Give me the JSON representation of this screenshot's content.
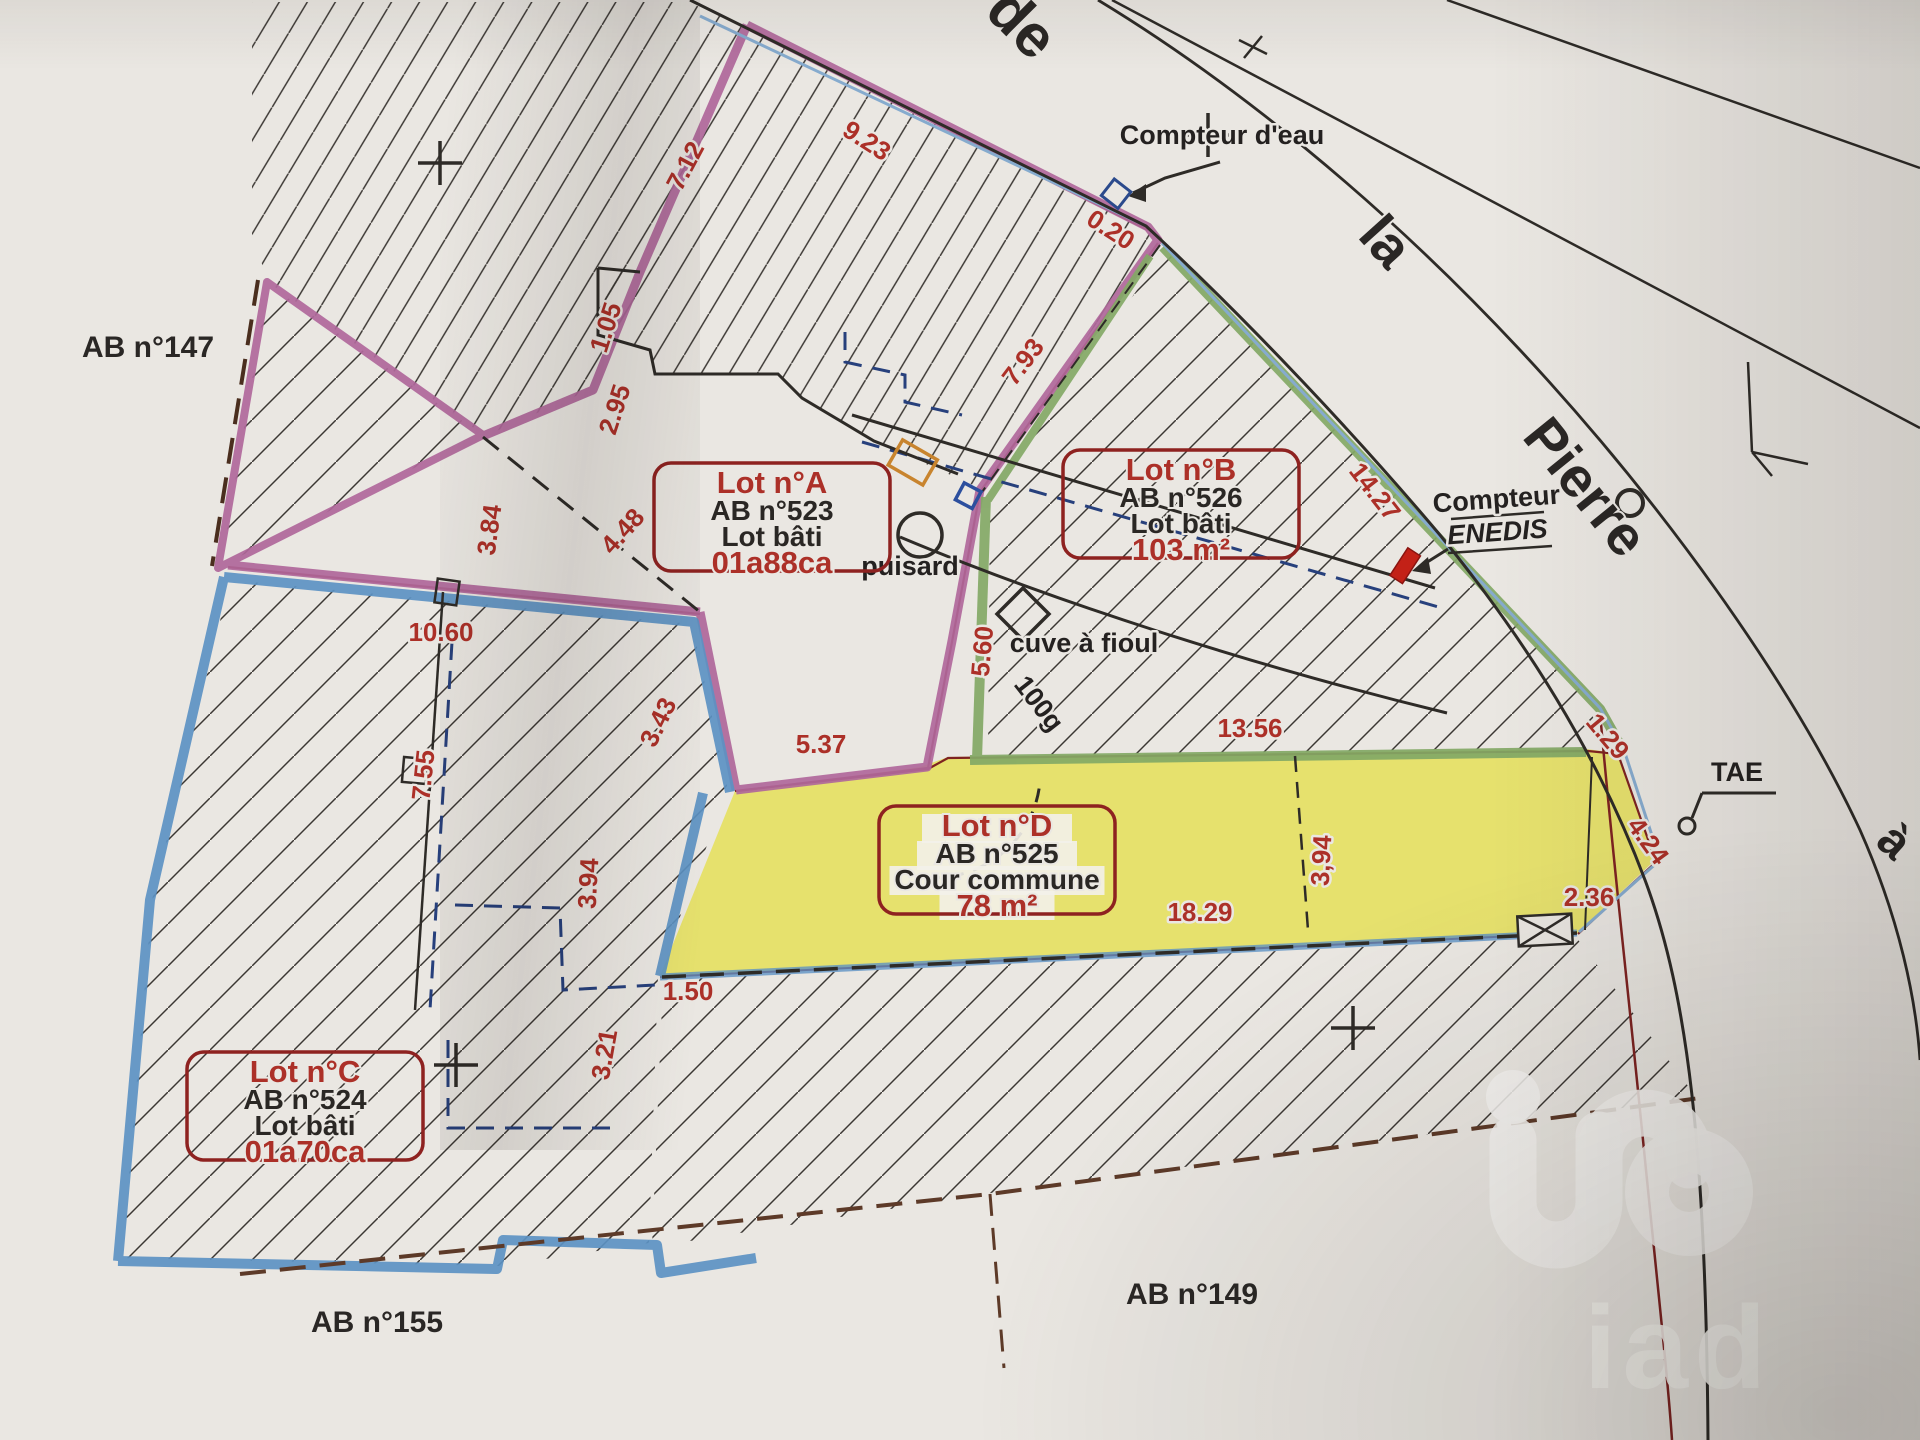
{
  "plan": {
    "kind": "cadastral-division-plan",
    "watermark": "iad",
    "street_words": [
      {
        "text": "de",
        "x": 1008,
        "y": 38,
        "rot": 45,
        "size": 60
      },
      {
        "text": "la",
        "x": 1372,
        "y": 254,
        "rot": 48,
        "size": 56
      },
      {
        "text": "Pierre",
        "x": 1571,
        "y": 499,
        "rot": 51,
        "size": 56
      },
      {
        "text": "à",
        "x": 1884,
        "y": 853,
        "rot": 42,
        "size": 48
      }
    ],
    "parcel_labels": [
      {
        "text": "AB n°147",
        "x": 148,
        "y": 357
      },
      {
        "text": "AB n°155",
        "x": 377,
        "y": 1332
      },
      {
        "text": "AB n°149",
        "x": 1192,
        "y": 1304
      }
    ],
    "lots": [
      {
        "id": "A",
        "title": "Lot n°A",
        "parcel": "AB n°523",
        "type": "Lot bâti",
        "area": "01a88ca",
        "cx": 772,
        "cy": 517,
        "highlight": false
      },
      {
        "id": "B",
        "title": "Lot n°B",
        "parcel": "AB n°526",
        "type": "Lot bâti",
        "area": "103 m²",
        "cx": 1181,
        "cy": 504,
        "highlight": false
      },
      {
        "id": "C",
        "title": "Lot n°C",
        "parcel": "AB n°524",
        "type": "Lot bâti",
        "area": "01a70ca",
        "cx": 305,
        "cy": 1106,
        "highlight": false
      },
      {
        "id": "D",
        "title": "Lot n°D",
        "parcel": "AB n°525",
        "type": "Cour commune",
        "area": "78 m²",
        "cx": 997,
        "cy": 860,
        "highlight": true
      }
    ],
    "utilities": [
      {
        "id": "compteur-eau",
        "label": "Compteur d'eau",
        "x": 1222,
        "y": 144,
        "rot": 0
      },
      {
        "id": "compteur-enedis",
        "label": "Compteur",
        "label2": "ENEDIS",
        "x": 1497,
        "y": 508,
        "rot": -4
      },
      {
        "id": "tae",
        "label": "TAE",
        "x": 1737,
        "y": 781,
        "rot": 0
      },
      {
        "id": "puisard",
        "label": "puisard",
        "x": 910,
        "y": 575,
        "rot": 0
      },
      {
        "id": "cuve-fioul",
        "label": "cuve à fioul",
        "x": 1084,
        "y": 652,
        "rot": 0
      },
      {
        "id": "angle-100g",
        "label": "100g",
        "x": 1032,
        "y": 709,
        "rot": 52
      }
    ],
    "measurements": [
      {
        "text": "7.12",
        "x": 693,
        "y": 170,
        "rot": -62
      },
      {
        "text": "9.23",
        "x": 862,
        "y": 148,
        "rot": 33
      },
      {
        "text": "0.20",
        "x": 1106,
        "y": 237,
        "rot": 33
      },
      {
        "text": "1.05",
        "x": 614,
        "y": 330,
        "rot": -72
      },
      {
        "text": "2.95",
        "x": 623,
        "y": 412,
        "rot": -72
      },
      {
        "text": "7.93",
        "x": 1030,
        "y": 367,
        "rot": -53
      },
      {
        "text": "14.27",
        "x": 1368,
        "y": 497,
        "rot": 52
      },
      {
        "text": "3.84",
        "x": 498,
        "y": 531,
        "rot": -82
      },
      {
        "text": "4.48",
        "x": 629,
        "y": 537,
        "rot": -48
      },
      {
        "text": "10.60",
        "x": 441,
        "y": 641,
        "rot": 0
      },
      {
        "text": "7.55",
        "x": 432,
        "y": 776,
        "rot": -84
      },
      {
        "text": "3.43",
        "x": 666,
        "y": 726,
        "rot": -64
      },
      {
        "text": "5.37",
        "x": 821,
        "y": 753,
        "rot": 0
      },
      {
        "text": "5.60",
        "x": 991,
        "y": 652,
        "rot": -85
      },
      {
        "text": "13.56",
        "x": 1250,
        "y": 737,
        "rot": 0
      },
      {
        "text": "1.29",
        "x": 1601,
        "y": 742,
        "rot": 50
      },
      {
        "text": "4.24",
        "x": 1641,
        "y": 846,
        "rot": 54
      },
      {
        "text": "2.36",
        "x": 1589,
        "y": 906,
        "rot": 0
      },
      {
        "text": "18.29",
        "x": 1200,
        "y": 921,
        "rot": 0
      },
      {
        "text": "3.94",
        "x": 597,
        "y": 884,
        "rot": -87
      },
      {
        "text": "3,94",
        "x": 1330,
        "y": 861,
        "rot": -87
      },
      {
        "text": "1.50",
        "x": 688,
        "y": 1000,
        "rot": 0
      },
      {
        "text": "3.21",
        "x": 613,
        "y": 1056,
        "rot": -80
      }
    ],
    "colors": {
      "paper": "#eae7e2",
      "lotA_pink": "#b0689b",
      "lotB_green": "#83a966",
      "lotC_blue": "#5c92c4",
      "lotD_yellow": "#e5e061",
      "dim_red": "#ac3028",
      "boundary_dark_red": "#7e2321",
      "street_blue": "#86abce",
      "navy_dash": "#27407c",
      "orange_symbol": "#c8842e",
      "enedis_red": "#c32117",
      "ink": "#2e2b27"
    }
  }
}
